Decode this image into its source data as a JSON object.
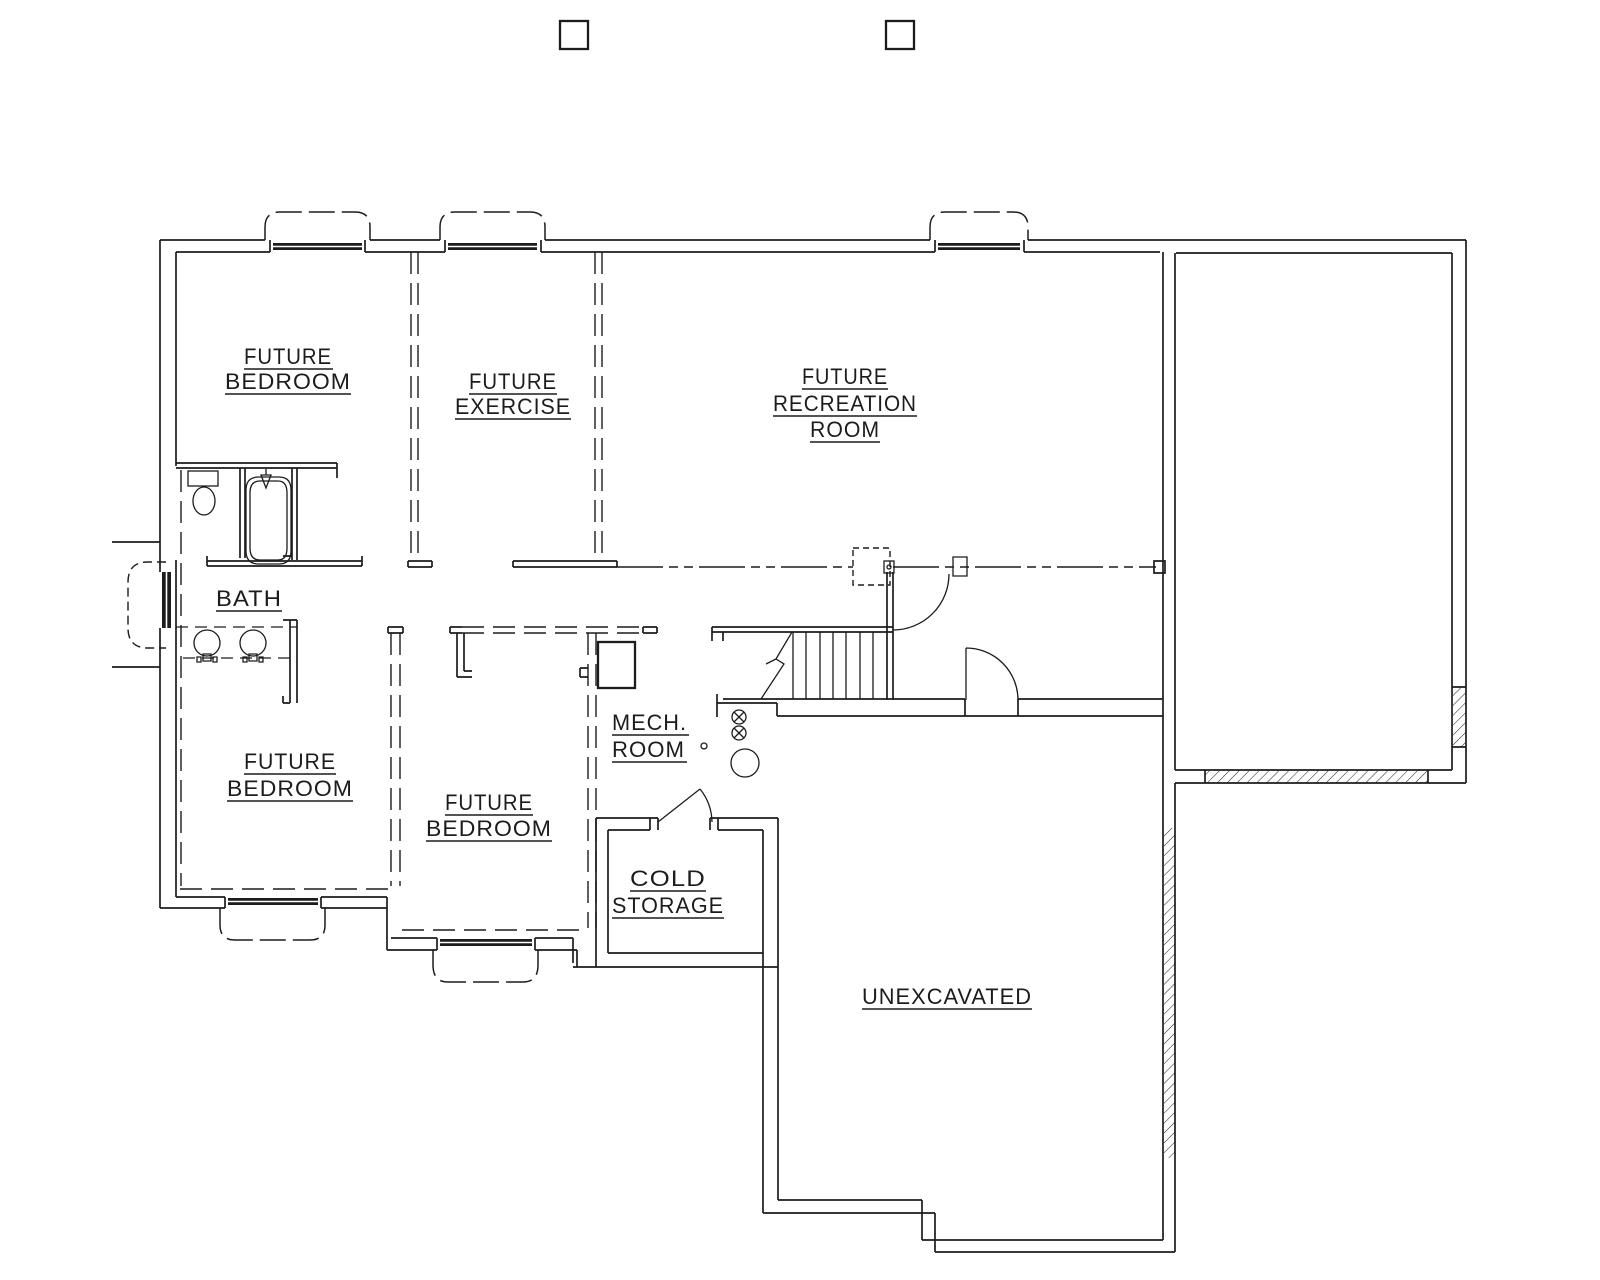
{
  "colors": {
    "ink": "#1c1c1c",
    "background": "#ffffff"
  },
  "rooms": {
    "bedroom_upper": {
      "line1": "FUTURE",
      "line2": "BEDROOM"
    },
    "exercise": {
      "line1": "FUTURE",
      "line2": "EXERCISE"
    },
    "recreation": {
      "line1": "FUTURE",
      "line2": "RECREATION",
      "line3": "ROOM"
    },
    "bath": {
      "line1": "BATH"
    },
    "bedroom_lower_left": {
      "line1": "FUTURE",
      "line2": "BEDROOM"
    },
    "bedroom_lower_mid": {
      "line1": "FUTURE",
      "line2": "BEDROOM"
    },
    "mech": {
      "line1": "MECH.",
      "line2": "ROOM"
    },
    "cold_storage": {
      "line1": "COLD",
      "line2": "STORAGE"
    },
    "unexcavated": {
      "line1": "UNEXCAVATED"
    }
  }
}
